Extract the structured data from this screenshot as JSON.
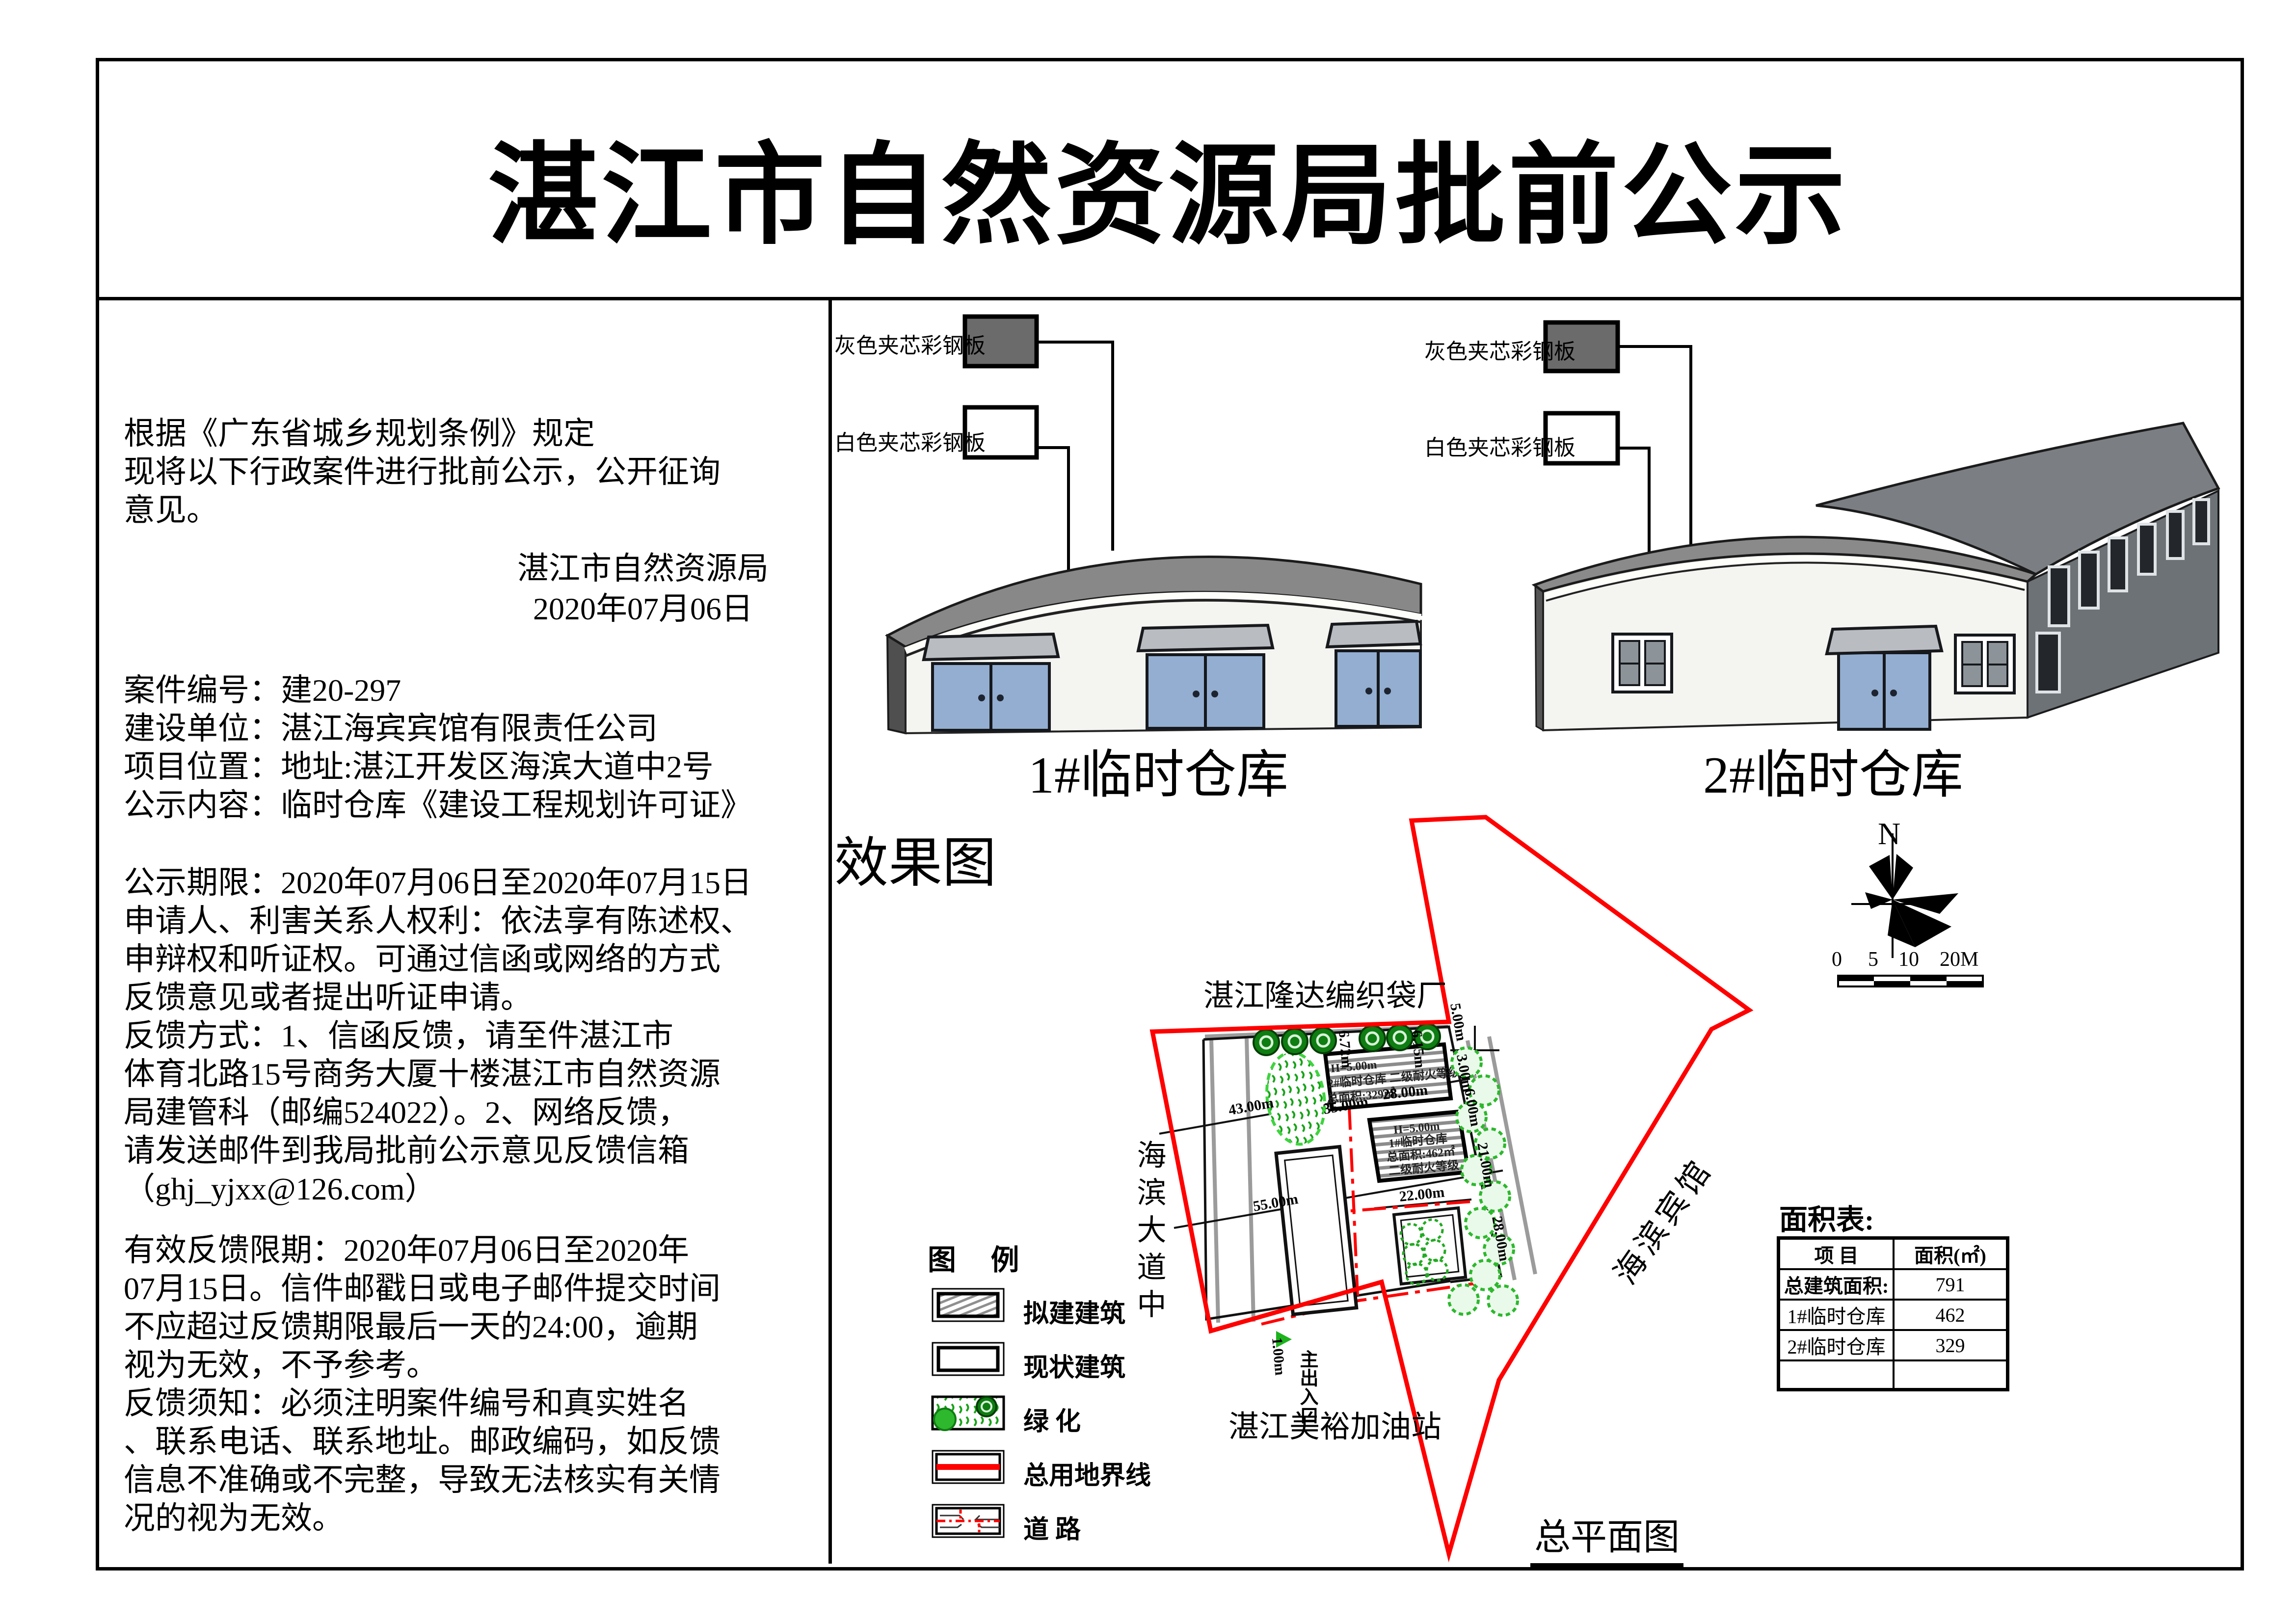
{
  "page": {
    "title": "湛江市自然资源局批前公示"
  },
  "notice": {
    "intro": [
      "根据《广东省城乡规划条例》规定",
      "现将以下行政案件进行批前公示，公开征询",
      "意见。"
    ],
    "agency": "湛江市自然资源局",
    "date": "2020年07月06日",
    "case_lines": [
      "案件编号：建20-297",
      "建设单位：湛江海宾宾馆有限责任公司",
      "项目位置：地址:湛江开发区海滨大道中2号",
      "公示内容：临时仓库《建设工程规划许可证》"
    ],
    "period_lines": [
      "公示期限：2020年07月06日至2020年07月15日",
      "申请人、利害关系人权利：依法享有陈述权、",
      "申辩权和听证权。可通过信函或网络的方式",
      "反馈意见或者提出听证申请。",
      "反馈方式：1、信函反馈，请至件湛江市",
      "体育北路15号商务大厦十楼湛江市自然资源",
      "局建管科（邮编524022）。2、网络反馈，",
      "请发送邮件到我局批前公示意见反馈信箱",
      "（ghj_yjxx@126.com）"
    ],
    "valid_lines": [
      "有效反馈限期：2020年07月06日至2020年",
      "07月15日。信件邮戳日或电子邮件提交时间",
      "不应超过反馈期限最后一天的24:00，逾期",
      "视为无效，不予参考。",
      "反馈须知：必须注明案件编号和真实姓名",
      "、联系电话、联系地址。邮政编码，如反馈",
      "信息不准确或不完整，导致无法核实有关情",
      "况的视为无效。"
    ]
  },
  "materials": {
    "gray": "灰色夹芯彩钢板",
    "white": "白色夹芯彩钢板"
  },
  "renderings": {
    "heading": "效果图",
    "b1": "1#临时仓库",
    "b2": "2#临时仓库"
  },
  "site": {
    "neighbor_top": "湛江隆达编织袋厂",
    "road_left": "海滨大道中",
    "neighbor_bottom": "湛江美裕加油站",
    "neighbor_right": "海滨宾馆",
    "plan_title": "总平面图",
    "entrance": "主出入口",
    "north": "N",
    "b1_plan": [
      "H=5.00m",
      "1#临时仓库",
      "总面积:462㎡",
      "二级耐火等级"
    ],
    "b2_plan": [
      "H=5.00m",
      "2#临时仓库 二级耐火等级",
      "总面积:329㎡"
    ],
    "dims": {
      "d43": "43.00m",
      "d55": "55.00m",
      "d35": "35.00m",
      "d28": "28.00m",
      "d22": "22.00m",
      "d21": "21.00m",
      "d672": "6.72m",
      "d615": "6.15m",
      "d3": "3.00m",
      "d6": "6.00m",
      "d5": "5.00m",
      "d28r": "28.00m",
      "d1": "1.00m"
    },
    "scale": {
      "s0": "0",
      "s5": "5",
      "s10": "10",
      "s20": "20M"
    }
  },
  "legend": {
    "title": "图  例",
    "items": [
      "拟建建筑",
      "现状建筑",
      "绿    化",
      "总用地界线",
      "道    路"
    ]
  },
  "area_table": {
    "title": "面积表:",
    "col1": "项  目",
    "col2": "面积(㎡)",
    "rows": [
      [
        "总建筑面积:",
        "791"
      ],
      [
        "1#临时仓库",
        "462"
      ],
      [
        "2#临时仓库",
        "329"
      ],
      [
        "",
        ""
      ]
    ]
  }
}
